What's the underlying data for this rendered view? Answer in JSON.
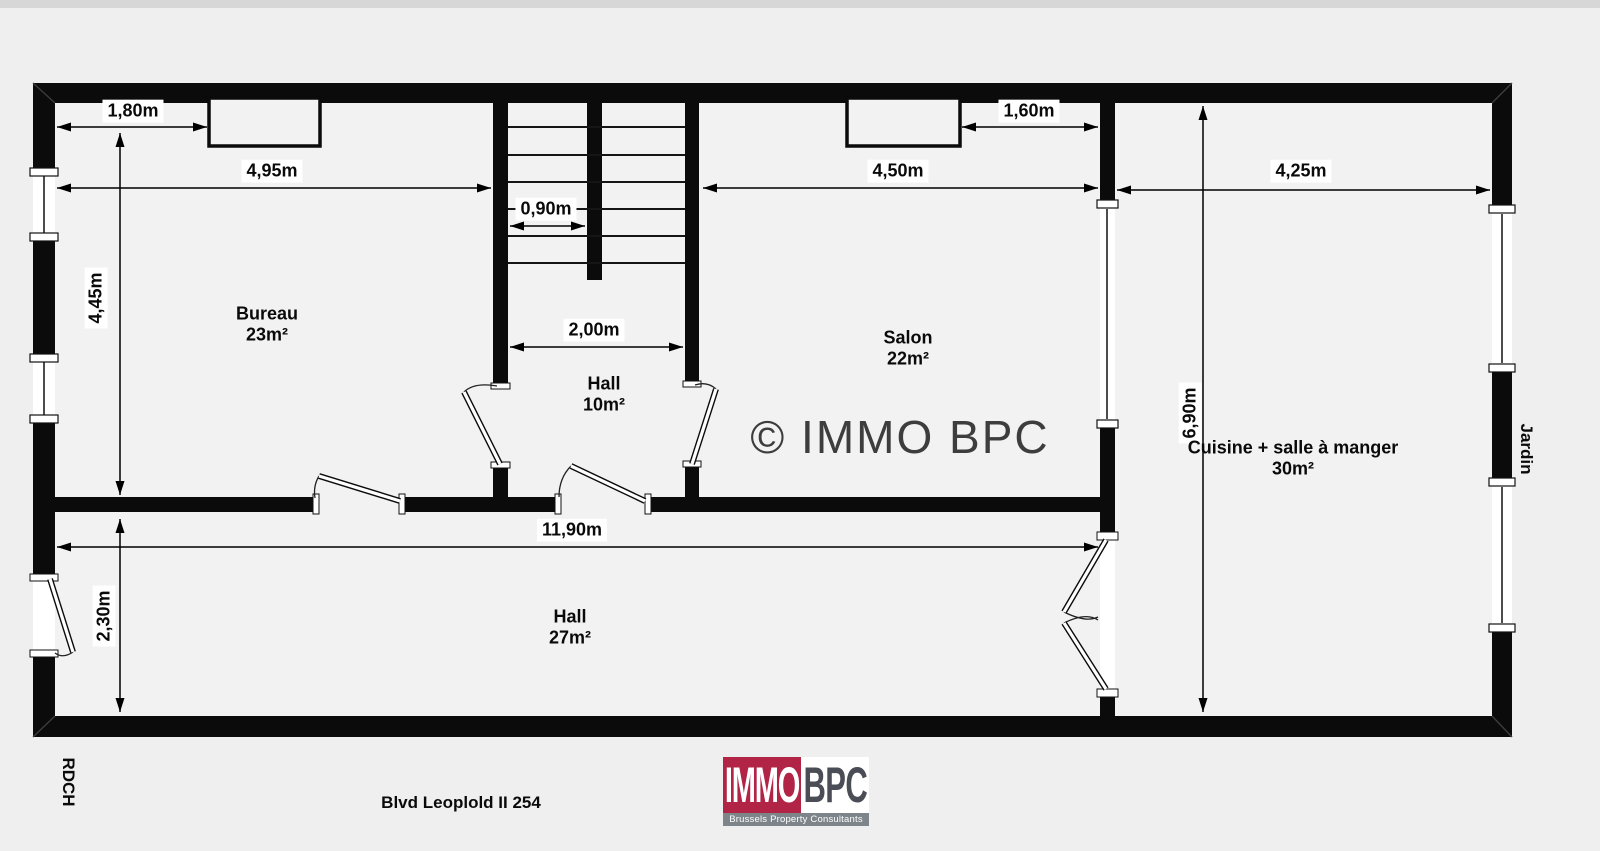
{
  "plan": {
    "floor": "RDCH",
    "address": "Blvd Leoplold II 254",
    "watermark": "© IMMO BPC",
    "garden_label": "Jardin",
    "rooms": [
      {
        "name": "Bureau",
        "area": "23m²"
      },
      {
        "name": "Hall",
        "area": "10m²"
      },
      {
        "name": "Salon",
        "area": "22m²"
      },
      {
        "name": "Cuisine + salle à manger",
        "area": "30m²"
      },
      {
        "name": "Hall",
        "area": "27m²"
      }
    ],
    "dimensions": {
      "bureau_window_offset": "1,80m",
      "bureau_width": "4,95m",
      "stair_width": "0,90m",
      "hall_width": "2,00m",
      "salon_width": "4,50m",
      "salon_window_offset": "1,60m",
      "kitchen_width": "4,25m",
      "bureau_depth": "4,45m",
      "hall_depth": "2,30m",
      "corridor_length": "11,90m",
      "kitchen_depth": "6,90m"
    }
  },
  "logo": {
    "immo": "IMMO",
    "bpc": "BPC",
    "tagline": "Brussels Property Consultants",
    "colors": {
      "red": "#b12445",
      "dark": "#4a4d55",
      "band": "#7d858b"
    }
  }
}
